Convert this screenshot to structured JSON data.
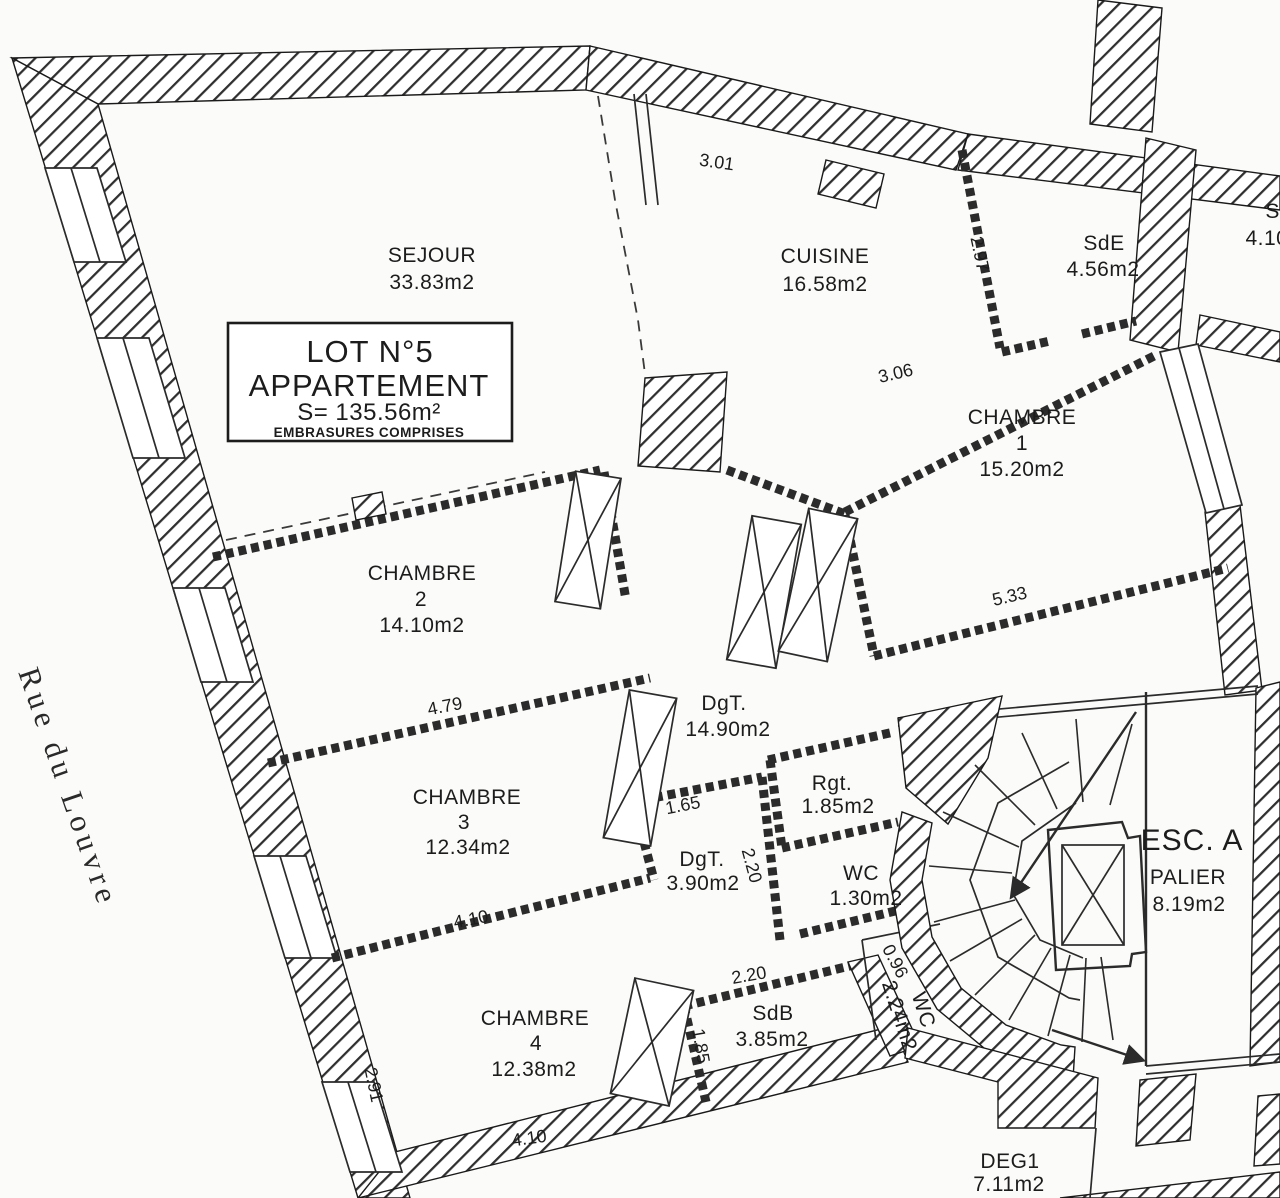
{
  "plan": {
    "street_label": "Rue du Louvre",
    "lot_box": {
      "line1": "LOT N°5",
      "line2": "APPARTEMENT",
      "line3": "S= 135.56m²",
      "line4": "EMBRASURES COMPRISES"
    },
    "rooms": {
      "sejour": {
        "name": "SEJOUR",
        "area": "33.83m2"
      },
      "cuisine": {
        "name": "CUISINE",
        "area": "16.58m2"
      },
      "sde": {
        "name": "SdE",
        "area": "4.56m2"
      },
      "sdb_clipped": {
        "name": "SdB",
        "area": "4.10m2"
      },
      "chambre1": {
        "name": "CHAMBRE",
        "num": "1",
        "area": "15.20m2"
      },
      "chambre2": {
        "name": "CHAMBRE",
        "num": "2",
        "area": "14.10m2"
      },
      "chambre3": {
        "name": "CHAMBRE",
        "num": "3",
        "area": "12.34m2"
      },
      "chambre4": {
        "name": "CHAMBRE",
        "num": "4",
        "area": "12.38m2"
      },
      "dgt_main": {
        "name": "DgT.",
        "area": "14.90m2"
      },
      "rgt": {
        "name": "Rgt.",
        "area": "1.85m2"
      },
      "dgt_small": {
        "name": "DgT.",
        "area": "3.90m2"
      },
      "wc_small": {
        "name": "WC",
        "area": "1.30m2"
      },
      "sdb": {
        "name": "SdB",
        "area": "3.85m2"
      },
      "wc_stair": {
        "name": "WC",
        "area": "2.24m2"
      },
      "deg1": {
        "name": "DEG1",
        "area": "7.11m2"
      }
    },
    "stair": {
      "label": "ESC. A",
      "palier": "PALIER",
      "palier_area": "8.19m2"
    },
    "dims": {
      "d1": "3.01",
      "d2": "2.97",
      "d3": "3.06",
      "d4": "5.33",
      "d5": "4.79",
      "d6": "1.65",
      "d7": "2.20",
      "d8": "4.10",
      "d9": "2.20",
      "d10": "1.85",
      "d11": "0.96",
      "d12": "2.91",
      "d13": "4.10"
    }
  }
}
